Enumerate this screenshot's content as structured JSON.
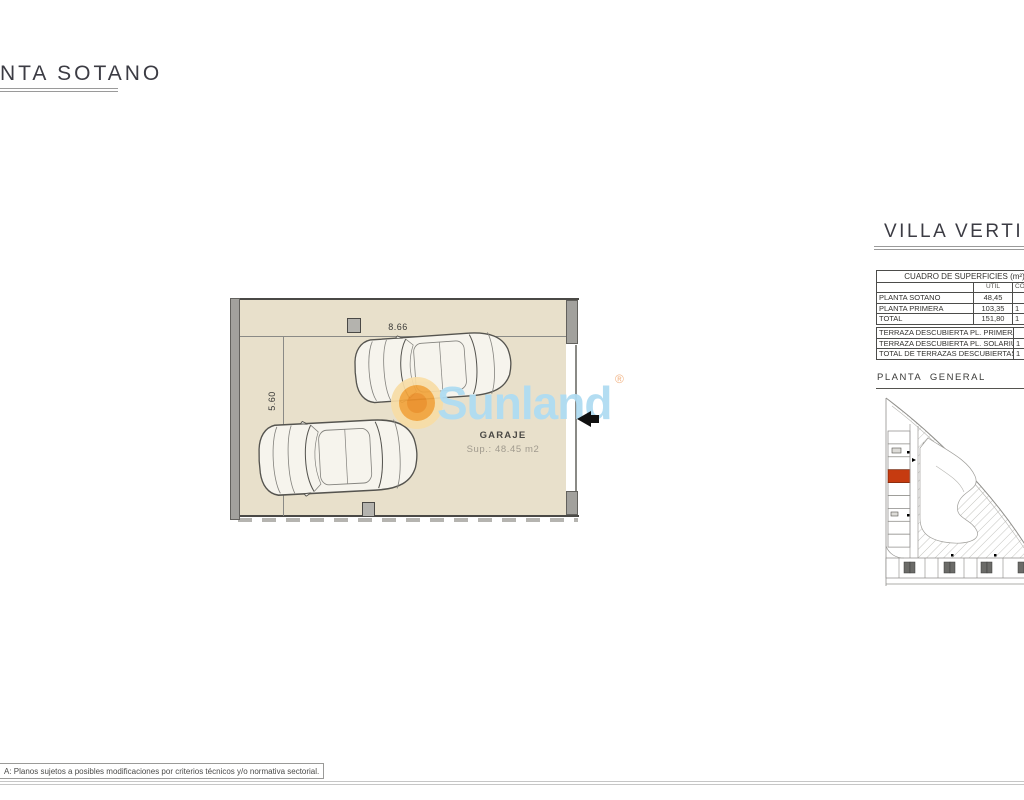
{
  "title": "NTA SOTANO",
  "plan": {
    "dim_width": "8.66",
    "dim_height": "5.60",
    "room": "GARAJE",
    "area": "Sup.: 48.45 m2"
  },
  "watermark": {
    "brand": "Sunland",
    "reg": "®"
  },
  "panel": {
    "title": "VILLA VERTICAL",
    "table1": {
      "header": "CUADRO DE SUPERFICIES (m²)",
      "cols": [
        "UTIL",
        "CON"
      ],
      "rows": [
        {
          "label": "PLANTA SOTANO",
          "util": "48,45",
          "con": ""
        },
        {
          "label": "PLANTA PRIMERA",
          "util": "103,35",
          "con": "1"
        },
        {
          "label": "TOTAL",
          "util": "151,80",
          "con": "1"
        }
      ]
    },
    "table2": {
      "rows": [
        {
          "label": "TERRAZA DESCUBIERTA PL. PRIMERA",
          "value": ""
        },
        {
          "label": "TERRAZA DESCUBIERTA PL. SOLARIUM",
          "value": "1"
        },
        {
          "label": "TOTAL DE TERRAZAS DESCUBIERTAS",
          "value": "1"
        }
      ]
    },
    "site_title": "PLANTA GENERAL"
  },
  "footer": {
    "note": "A: Planos sujetos a posibles modificaciones por criterios técnicos y/o normativa sectorial."
  },
  "colors": {
    "floor_beige": "#e8e0cb",
    "wall_gray": "#a2a19d",
    "highlight_red": "#c63b10",
    "brand_blue": "#afdcf2",
    "sun_orange": "#f2a43c"
  }
}
